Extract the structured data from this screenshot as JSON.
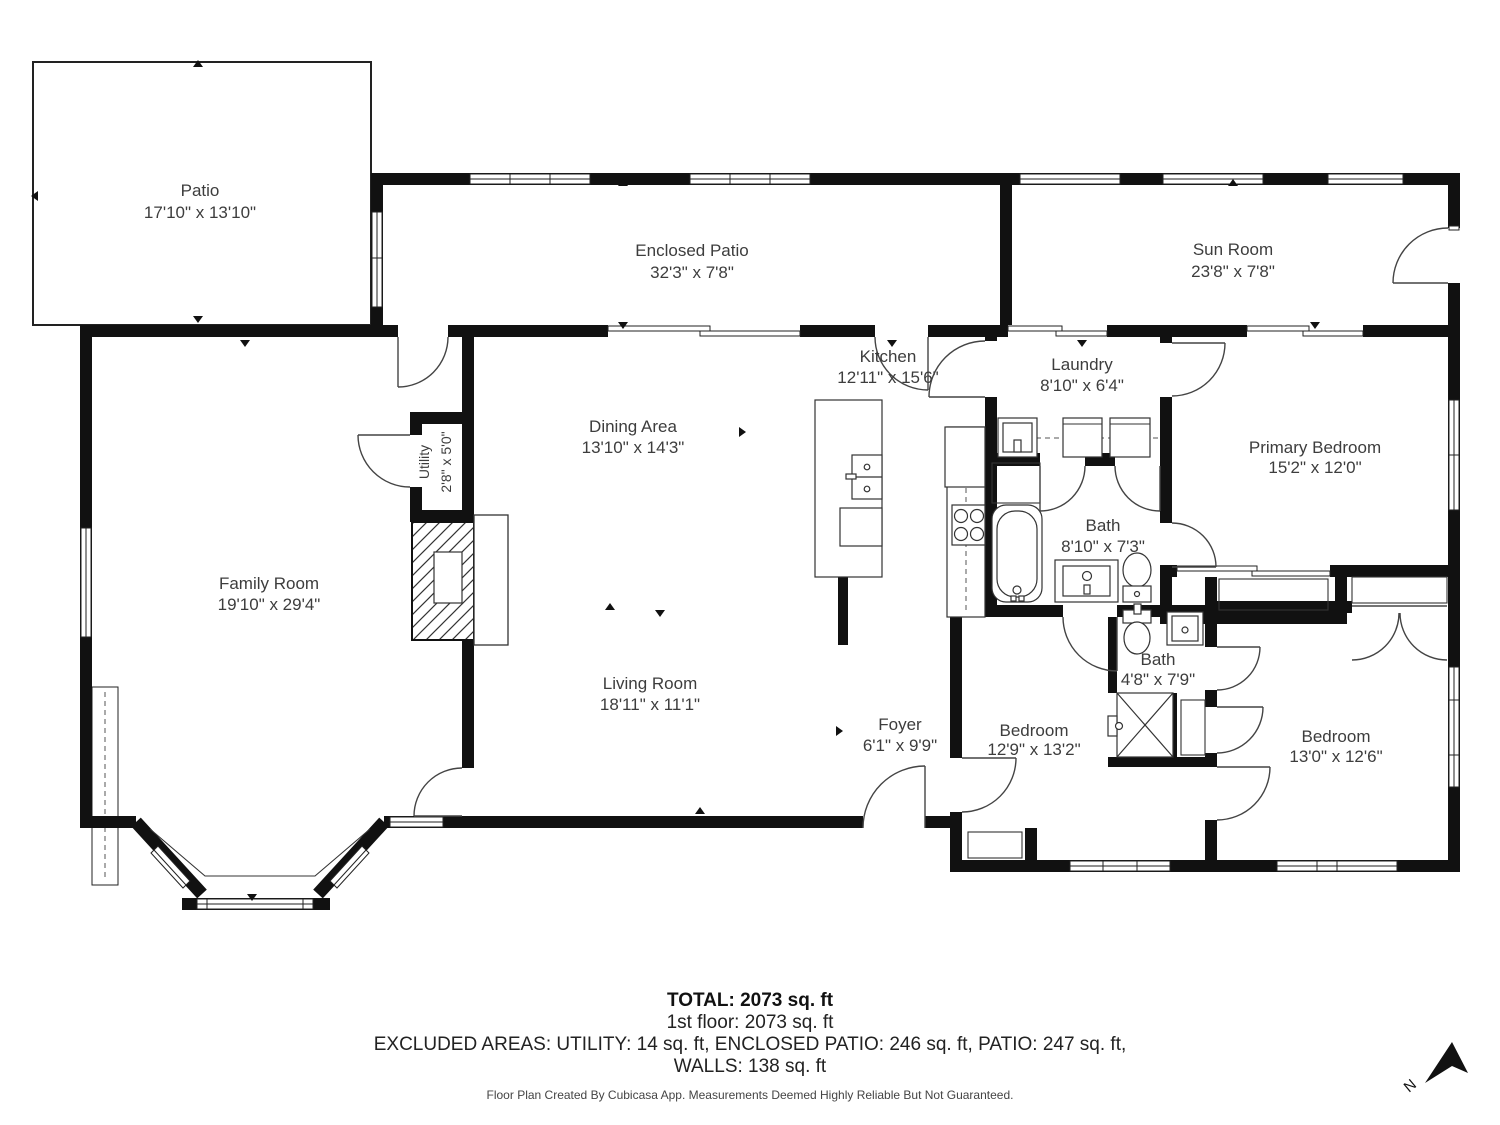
{
  "rooms": [
    {
      "name": "Patio",
      "dims": "17'10\" x 13'10\""
    },
    {
      "name": "Enclosed Patio",
      "dims": "32'3\" x 7'8\""
    },
    {
      "name": "Sun Room",
      "dims": "23'8\" x 7'8\""
    },
    {
      "name": "Kitchen",
      "dims": "12'11\" x 15'6\""
    },
    {
      "name": "Laundry",
      "dims": "8'10\" x 6'4\""
    },
    {
      "name": "Primary Bedroom",
      "dims": "15'2\" x 12'0\""
    },
    {
      "name": "Dining Area",
      "dims": "13'10\" x 14'3\""
    },
    {
      "name": "Utility",
      "dims": "2'8\" x 5'0\""
    },
    {
      "name": "Bath",
      "dims": "8'10\" x 7'3\""
    },
    {
      "name": "Family Room",
      "dims": "19'10\" x 29'4\""
    },
    {
      "name": "Living Room",
      "dims": "18'11\" x 11'1\""
    },
    {
      "name": "Foyer",
      "dims": "6'1\" x 9'9\""
    },
    {
      "name": "Bedroom",
      "dims": "12'9\" x 13'2\""
    },
    {
      "name": "Bath",
      "dims": "4'8\" x 7'9\""
    },
    {
      "name": "Bedroom",
      "dims": "13'0\" x 12'6\""
    }
  ],
  "summary": {
    "total": "TOTAL: 2073 sq. ft",
    "first_floor": "1st floor: 2073 sq. ft",
    "excluded": "EXCLUDED AREAS: UTILITY: 14 sq. ft, ENCLOSED PATIO: 246 sq. ft, PATIO: 247 sq. ft,",
    "walls": "WALLS: 138 sq. ft",
    "disclaimer": "Floor Plan Created By Cubicasa App. Measurements Deemed Highly Reliable But Not Guaranteed."
  },
  "compass": {
    "label": "N"
  }
}
